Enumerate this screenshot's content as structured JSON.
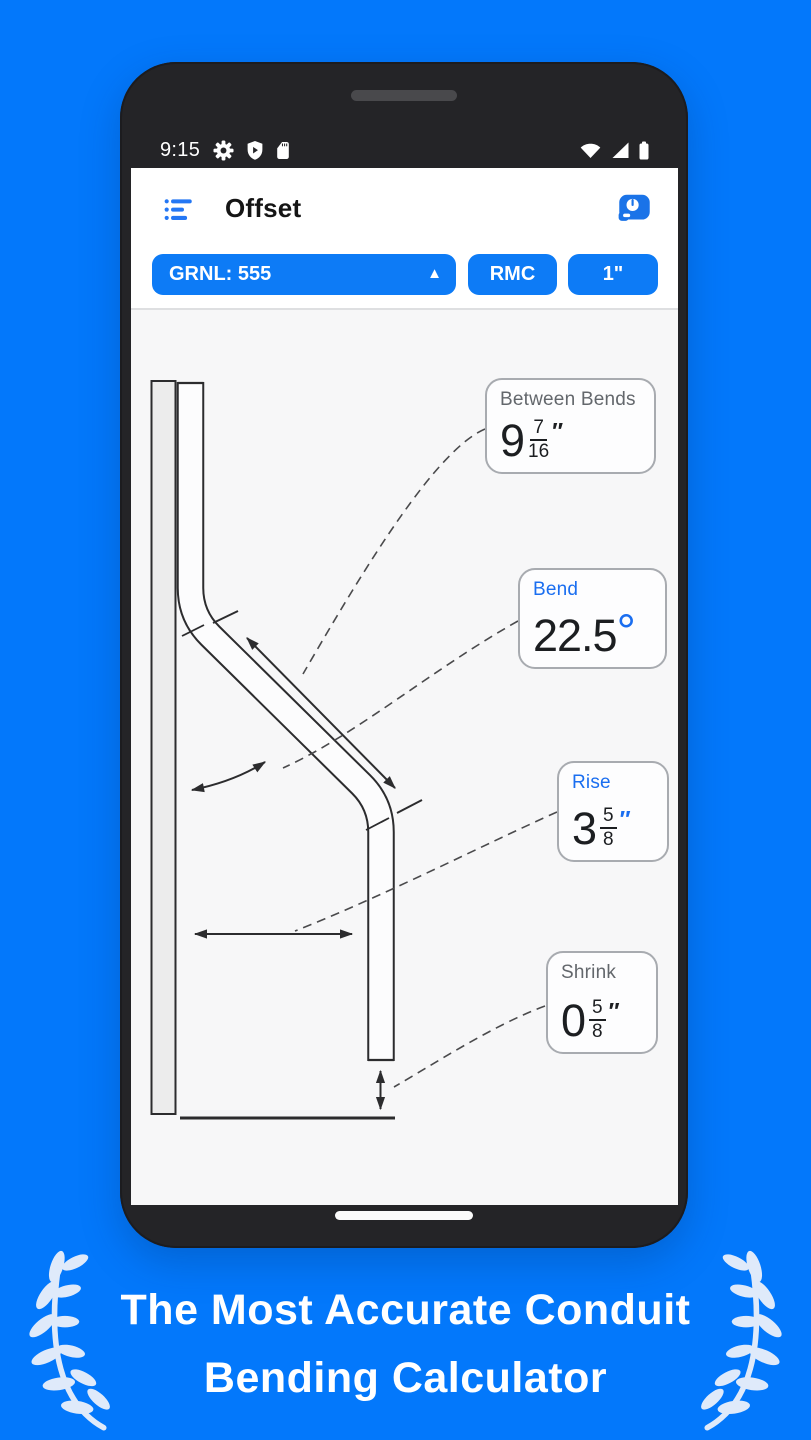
{
  "colors": {
    "background_blue": "#0378fb",
    "button_blue": "#0d7bf6",
    "accent_blue": "#1a6ef0",
    "phone_bezel": "#242427",
    "content_background": "#f7f7f8",
    "value_text": "#1c1e21",
    "muted_label": "#63676c",
    "callout_border": "#a8abb0",
    "diagram_stroke": "#2c2c2e",
    "laurel": "#dfeafa"
  },
  "phone": {
    "status_bar": {
      "time": "9:15",
      "left_icons": [
        "gear",
        "shield-play",
        "sd-card"
      ],
      "right_icons": [
        "wifi",
        "signal",
        "battery"
      ]
    },
    "app_bar": {
      "title": "Offset",
      "menu_icon": "list-menu",
      "action_icon": "tape-measure"
    },
    "toolbar": {
      "bender_label": "GRNL: 555",
      "bender_dropdown_glyph": "▲",
      "material_label": "RMC",
      "size_label": "1\""
    },
    "callouts": [
      {
        "name": "between-bends",
        "label": "Between Bends",
        "whole": "9",
        "numerator": "7",
        "denominator": "16",
        "unit": "″",
        "style": "computed"
      },
      {
        "name": "bend",
        "label": "Bend",
        "whole": "22.5",
        "unit": "°",
        "style": "input"
      },
      {
        "name": "rise",
        "label": "Rise",
        "whole": "3",
        "numerator": "5",
        "denominator": "8",
        "unit": "″",
        "style": "input"
      },
      {
        "name": "shrink",
        "label": "Shrink",
        "whole": "0",
        "numerator": "5",
        "denominator": "8",
        "unit": "″",
        "style": "computed"
      }
    ]
  },
  "caption": {
    "line1": "The Most Accurate Conduit",
    "line2": "Bending Calculator"
  }
}
